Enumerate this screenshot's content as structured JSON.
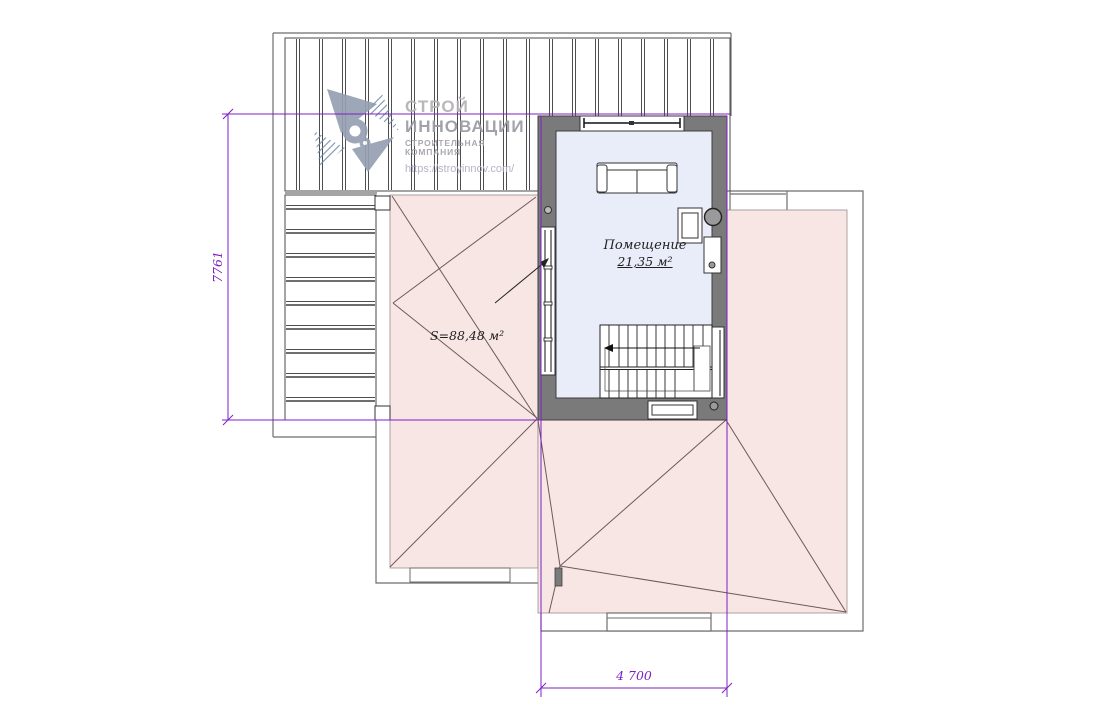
{
  "logo": {
    "title_line1": "СТРОЙ",
    "title_line2": "ИННОВАЦИИ",
    "subtitle": "СТРОИТЕЛЬНАЯ КОМПАНИЯ",
    "url": "https://stroyinnov.com/"
  },
  "labels": {
    "room_name": "Помещение",
    "room_area": "21,35 м²",
    "total_area": "S=88,48 м²"
  },
  "dimensions": {
    "vertical_mm": "7761",
    "horizontal_mm": "4 700"
  },
  "colors": {
    "dimension_purple": "#7d1fc4",
    "roof_pink": "#f8e6e5",
    "room_fill": "#e9edf9",
    "wall_gray": "#7a7a7a",
    "hip_line": "#6e5a58",
    "logo_blue_gray": "#95a0b1"
  }
}
